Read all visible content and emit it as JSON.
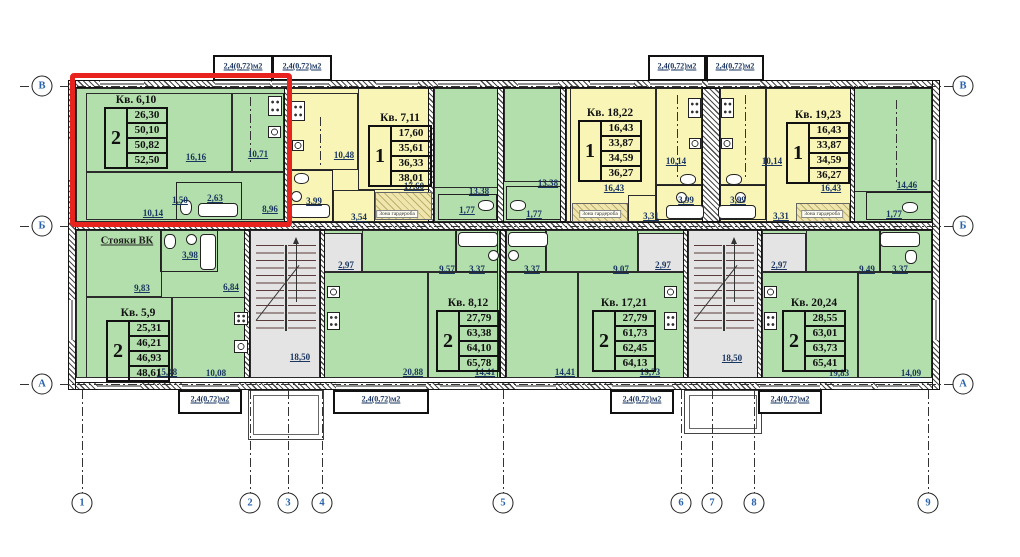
{
  "drawing_title": "Типовой этаж — план квартир",
  "colors": {
    "apartment_green": "#b3dfac",
    "apartment_yellow": "#f8f5b6",
    "stair_gray": "#e4e4e4",
    "highlight_red": "#e8231d",
    "axis_text": "#2a63ad",
    "dim_text": "#1a3560"
  },
  "apartments": [
    {
      "name": "Кв. 6,10",
      "rooms": "2",
      "values": [
        "26,30",
        "50,10",
        "50,82",
        "52,50"
      ],
      "x": 104,
      "y": 94,
      "highlighted": true
    },
    {
      "name": "Кв. 7,11",
      "rooms": "1",
      "values": [
        "17,60",
        "35,61",
        "36,33",
        "38,01"
      ],
      "x": 368,
      "y": 112,
      "highlighted": false
    },
    {
      "name": "Кв. 18,22",
      "rooms": "1",
      "values": [
        "16,43",
        "33,87",
        "34,59",
        "36,27"
      ],
      "x": 578,
      "y": 107,
      "highlighted": false
    },
    {
      "name": "Кв. 19,23",
      "rooms": "1",
      "values": [
        "16,43",
        "33,87",
        "34,59",
        "36,27"
      ],
      "x": 786,
      "y": 109,
      "highlighted": false
    },
    {
      "name": "Кв. 5,9",
      "rooms": "2",
      "values": [
        "25,31",
        "46,21",
        "46,93",
        "48,61"
      ],
      "x": 106,
      "y": 307,
      "highlighted": false
    },
    {
      "name": "Кв. 8,12",
      "rooms": "2",
      "values": [
        "27,79",
        "63,38",
        "64,10",
        "65,78"
      ],
      "x": 436,
      "y": 297,
      "highlighted": false
    },
    {
      "name": "Кв. 17,21",
      "rooms": "2",
      "values": [
        "27,79",
        "61,73",
        "62,45",
        "64,13"
      ],
      "x": 592,
      "y": 297,
      "highlighted": false
    },
    {
      "name": "Кв. 20,24",
      "rooms": "2",
      "values": [
        "28,55",
        "63,01",
        "63,73",
        "65,41"
      ],
      "x": 782,
      "y": 297,
      "highlighted": false
    }
  ],
  "dimensions": [
    {
      "t": "16,16",
      "x": 196,
      "y": 157
    },
    {
      "t": "10,71",
      "x": 258,
      "y": 154
    },
    {
      "t": "10,14",
      "x": 153,
      "y": 213
    },
    {
      "t": "1,50",
      "x": 180,
      "y": 200
    },
    {
      "t": "2,63",
      "x": 215,
      "y": 198
    },
    {
      "t": "8,96",
      "x": 270,
      "y": 209
    },
    {
      "t": "10,48",
      "x": 344,
      "y": 155
    },
    {
      "t": "17,60",
      "x": 414,
      "y": 186
    },
    {
      "t": "3,99",
      "x": 314,
      "y": 201
    },
    {
      "t": "3,54",
      "x": 359,
      "y": 217
    },
    {
      "t": "13,38",
      "x": 479,
      "y": 191
    },
    {
      "t": "1,77",
      "x": 467,
      "y": 210
    },
    {
      "t": "13,38",
      "x": 548,
      "y": 183
    },
    {
      "t": "1,77",
      "x": 534,
      "y": 214
    },
    {
      "t": "16,43",
      "x": 614,
      "y": 188
    },
    {
      "t": "3,31",
      "x": 651,
      "y": 216
    },
    {
      "t": "10,14",
      "x": 676,
      "y": 161
    },
    {
      "t": "3,99",
      "x": 686,
      "y": 200
    },
    {
      "t": "3,99",
      "x": 738,
      "y": 200
    },
    {
      "t": "10,14",
      "x": 772,
      "y": 161
    },
    {
      "t": "3,31",
      "x": 781,
      "y": 216
    },
    {
      "t": "16,43",
      "x": 831,
      "y": 188
    },
    {
      "t": "14,46",
      "x": 907,
      "y": 185
    },
    {
      "t": "1,77",
      "x": 894,
      "y": 214
    },
    {
      "t": "3,98",
      "x": 190,
      "y": 255
    },
    {
      "t": "9,83",
      "x": 142,
      "y": 288
    },
    {
      "t": "6,84",
      "x": 231,
      "y": 287
    },
    {
      "t": "15,48",
      "x": 167,
      "y": 372
    },
    {
      "t": "10,08",
      "x": 216,
      "y": 373
    },
    {
      "t": "18,50",
      "x": 300,
      "y": 357
    },
    {
      "t": "2,97",
      "x": 346,
      "y": 265
    },
    {
      "t": "9,57",
      "x": 447,
      "y": 269
    },
    {
      "t": "3,37",
      "x": 477,
      "y": 269
    },
    {
      "t": "3,37",
      "x": 532,
      "y": 269
    },
    {
      "t": "20,88",
      "x": 413,
      "y": 372
    },
    {
      "t": "14,41",
      "x": 485,
      "y": 372
    },
    {
      "t": "14,41",
      "x": 565,
      "y": 372
    },
    {
      "t": "9,07",
      "x": 621,
      "y": 269
    },
    {
      "t": "2,97",
      "x": 663,
      "y": 265
    },
    {
      "t": "19,73",
      "x": 650,
      "y": 372
    },
    {
      "t": "18,50",
      "x": 732,
      "y": 358
    },
    {
      "t": "2,97",
      "x": 779,
      "y": 265
    },
    {
      "t": "9,49",
      "x": 867,
      "y": 269
    },
    {
      "t": "3,37",
      "x": 900,
      "y": 269
    },
    {
      "t": "19,83",
      "x": 839,
      "y": 373
    },
    {
      "t": "14,09",
      "x": 911,
      "y": 373
    }
  ],
  "balcony_labels": [
    {
      "t": "2,4(0,72)м2",
      "x": 243,
      "y": 66
    },
    {
      "t": "2,4(0,72)м2",
      "x": 302,
      "y": 66
    },
    {
      "t": "2,4(0,72)м2",
      "x": 677,
      "y": 66
    },
    {
      "t": "2,4(0,72)м2",
      "x": 735,
      "y": 66
    },
    {
      "t": "2,4(0,72)м2",
      "x": 210,
      "y": 399
    },
    {
      "t": "2,4(0,72)м2",
      "x": 381,
      "y": 399
    },
    {
      "t": "2,4(0,72)м2",
      "x": 642,
      "y": 399
    },
    {
      "t": "2,4(0,72)м2",
      "x": 790,
      "y": 399
    }
  ],
  "wardrobe_labels": [
    {
      "t": "Зона гардероба",
      "x": 397,
      "y": 214
    },
    {
      "t": "Зона гардероба",
      "x": 600,
      "y": 214
    },
    {
      "t": "Зона гардероба",
      "x": 822,
      "y": 214
    }
  ],
  "risers_label": {
    "t": "Стояки ВК",
    "x": 127,
    "y": 241
  },
  "axis_rows": [
    {
      "t": "В",
      "y": 86
    },
    {
      "t": "Б",
      "y": 226
    },
    {
      "t": "А",
      "y": 384
    }
  ],
  "axis_cols": [
    {
      "t": "1",
      "x": 82
    },
    {
      "t": "2",
      "x": 250
    },
    {
      "t": "3",
      "x": 288
    },
    {
      "t": "4",
      "x": 322
    },
    {
      "t": "5",
      "x": 503
    },
    {
      "t": "6",
      "x": 681
    },
    {
      "t": "7",
      "x": 712
    },
    {
      "t": "8",
      "x": 754
    },
    {
      "t": "9",
      "x": 928
    }
  ]
}
